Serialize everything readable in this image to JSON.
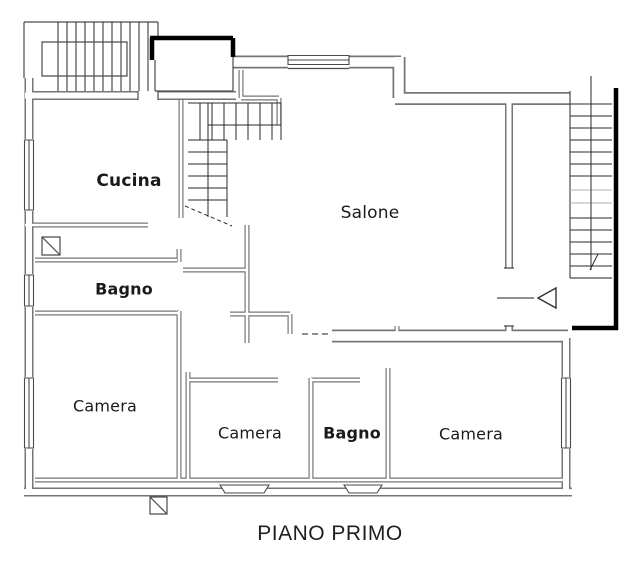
{
  "floor_plan": {
    "caption": "PIANO PRIMO",
    "rooms": [
      {
        "name": "Cucina",
        "bold": true
      },
      {
        "name": "Salone",
        "bold": false
      },
      {
        "name": "Bagno",
        "bold": true
      },
      {
        "name": "Camera",
        "bold": false
      },
      {
        "name": "Camera",
        "bold": false
      },
      {
        "name": "Bagno",
        "bold": true
      },
      {
        "name": "Camera",
        "bold": false
      }
    ],
    "symbols": [
      "stairs-top-left",
      "stairs-central",
      "stairs-right",
      "entrance-arrow",
      "window-symbols",
      "shaft-symbols",
      "dashed-opening"
    ],
    "colors": {
      "background": "#ffffff",
      "wall_line": "#767676",
      "detail_line": "#4a4a4a",
      "thick_wall": "#000000",
      "label_text": "#1a1a1a"
    }
  }
}
